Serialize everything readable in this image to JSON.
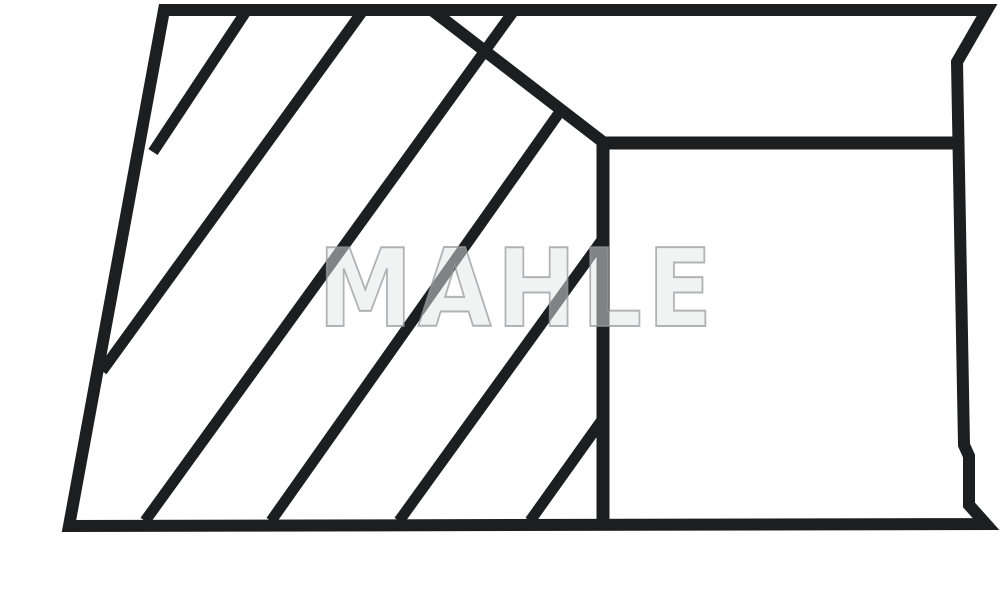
{
  "page": {
    "background_color": "#ffffff"
  },
  "watermark": {
    "text": "MAHLE",
    "fill_color": "rgba(228,231,232,0.5)",
    "outline_color": "rgba(148,153,156,0.72)",
    "outline_width": "2px"
  },
  "diagram": {
    "description": "piston-ring cross-section technical line drawing",
    "stroke_color": "#1d1e20",
    "outline": {
      "stroke_width": 12,
      "points": [
        [
          164,
          10
        ],
        [
          987,
          10
        ],
        [
          957,
          62
        ],
        [
          964,
          445
        ],
        [
          969,
          456
        ],
        [
          969,
          505
        ],
        [
          986,
          524
        ],
        [
          69,
          526
        ]
      ]
    },
    "inner_lines": [
      {
        "name": "step-diagonal-line",
        "stroke_width": 12,
        "points": [
          [
            433,
            11
          ],
          [
            603,
            142
          ]
        ]
      },
      {
        "name": "inner-horizontal-line",
        "stroke_width": 13,
        "points": [
          [
            597,
            143
          ],
          [
            962,
            143
          ]
        ]
      },
      {
        "name": "inner-vertical-line",
        "stroke_width": 13,
        "points": [
          [
            603,
            137
          ],
          [
            603,
            523
          ]
        ]
      }
    ],
    "hatch_lines": {
      "stroke_width": 11,
      "segments": [
        [
          [
            245,
            13
          ],
          [
            153,
            152
          ]
        ],
        [
          [
            362,
            12
          ],
          [
            102,
            371
          ]
        ],
        [
          [
            513,
            12
          ],
          [
            145,
            521
          ]
        ],
        [
          [
            559,
            113
          ],
          [
            271,
            521
          ]
        ],
        [
          [
            602,
            240
          ],
          [
            399,
            521
          ]
        ],
        [
          [
            602,
            420
          ],
          [
            530,
            521
          ]
        ]
      ]
    }
  }
}
